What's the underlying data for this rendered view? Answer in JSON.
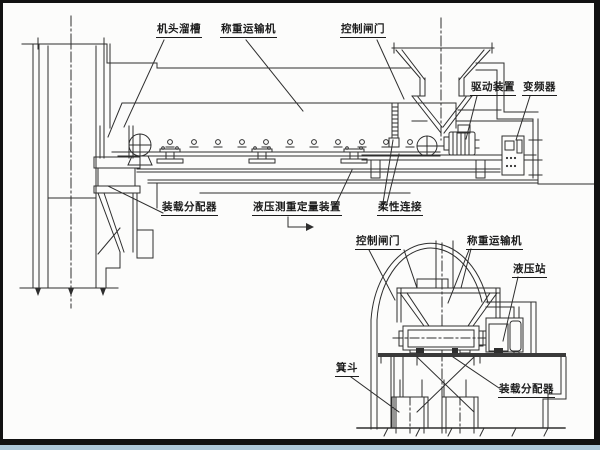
{
  "figure_type": "engineering schematic of a skip-loading weighing conveyor system, side view and cross-section view",
  "colors": {
    "ink": "#2e2e2e",
    "paper": "#fcfcfb",
    "frame": "#121212",
    "bottom_strip": "#aec9da"
  },
  "labels": {
    "main": {
      "head_chute": "机头溜槽",
      "weighing_conveyor": "称重运输机",
      "control_gate": "控制闸门",
      "drive_unit": "驱动装置",
      "frequency_converter": "变频器",
      "loading_distributor": "装载分配器",
      "hydraulic_weighing_device": "液压测重定量装置",
      "flexible_connection": "柔性连接"
    },
    "section": {
      "control_gate": "控制闸门",
      "weighing_conveyor": "称重运输机",
      "hydraulic_station": "液压站",
      "skip": "箕斗",
      "loading_distributor": "装载分配器"
    }
  }
}
